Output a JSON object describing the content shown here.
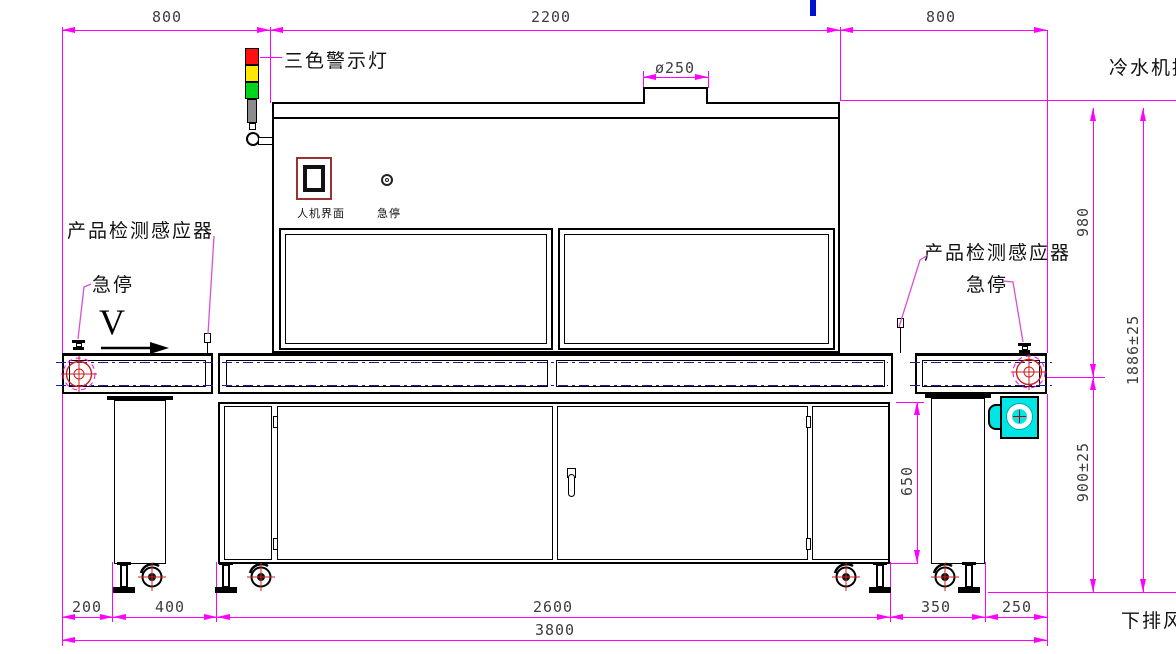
{
  "labels": {
    "warning_light": "三色警示灯",
    "hmi_screen": "人机界面",
    "hmi_estop": "急停",
    "sensor_left": "产品检测感应器",
    "estop_left": "急停",
    "sensor_right": "产品检测感应器",
    "estop_right": "急停",
    "belt_direction": "V",
    "chiller_note": "冷水机接",
    "exhaust_note": "下排风"
  },
  "dimensions": {
    "top_left_span": "800",
    "top_center_span": "2200",
    "top_right_span": "800",
    "duct_diameter": "ø250",
    "oven_height": "980",
    "overall_height": "1886±25",
    "belt_height": "900±25",
    "cabinet_height": "650",
    "bottom_spans": [
      "200",
      "400",
      "2600",
      "350",
      "250"
    ],
    "overall_length": "3800"
  },
  "colors": {
    "dimension_line": "#FF00FF",
    "leader_line": "#D94FD9",
    "centerline": "#1F1F8F",
    "outline": "#000000",
    "lamp_red": "#FF1010",
    "lamp_yellow": "#FFE800",
    "lamp_green": "#00D51C",
    "lamp_body_gray": "#8C8C8C",
    "fan_cyan": "#00E5E5",
    "crosshair_red": "#CC2020",
    "hmi_frame": "#993333",
    "stray_mark_blue": "#0014CC"
  }
}
